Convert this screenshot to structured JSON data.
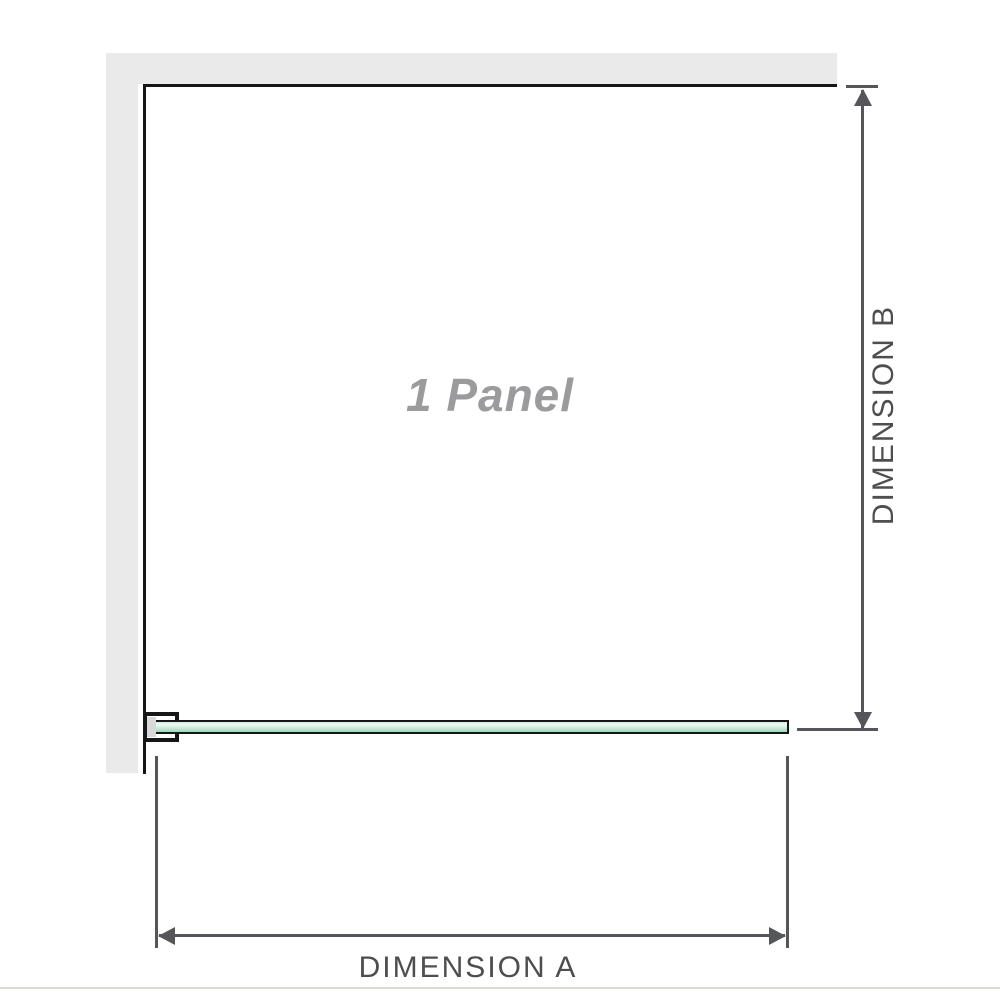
{
  "diagram": {
    "panel_label": "1 Panel",
    "dimensions": {
      "a_label": "DIMENSION A",
      "b_label": "DIMENSION B"
    }
  },
  "colors": {
    "wall": "#eaeaea",
    "outline": "#161616",
    "dimension": "#55565a",
    "label_text": "#4d4e50",
    "panel_text": "#9b9b9e",
    "glass_top": "#d5efe2",
    "glass_high": "#eef9f2",
    "glass_mid": "#c9ead8",
    "glass_deep": "#9fd8bc",
    "bracket_insert": "#d9d9d9",
    "divider": "#dcdad3"
  }
}
